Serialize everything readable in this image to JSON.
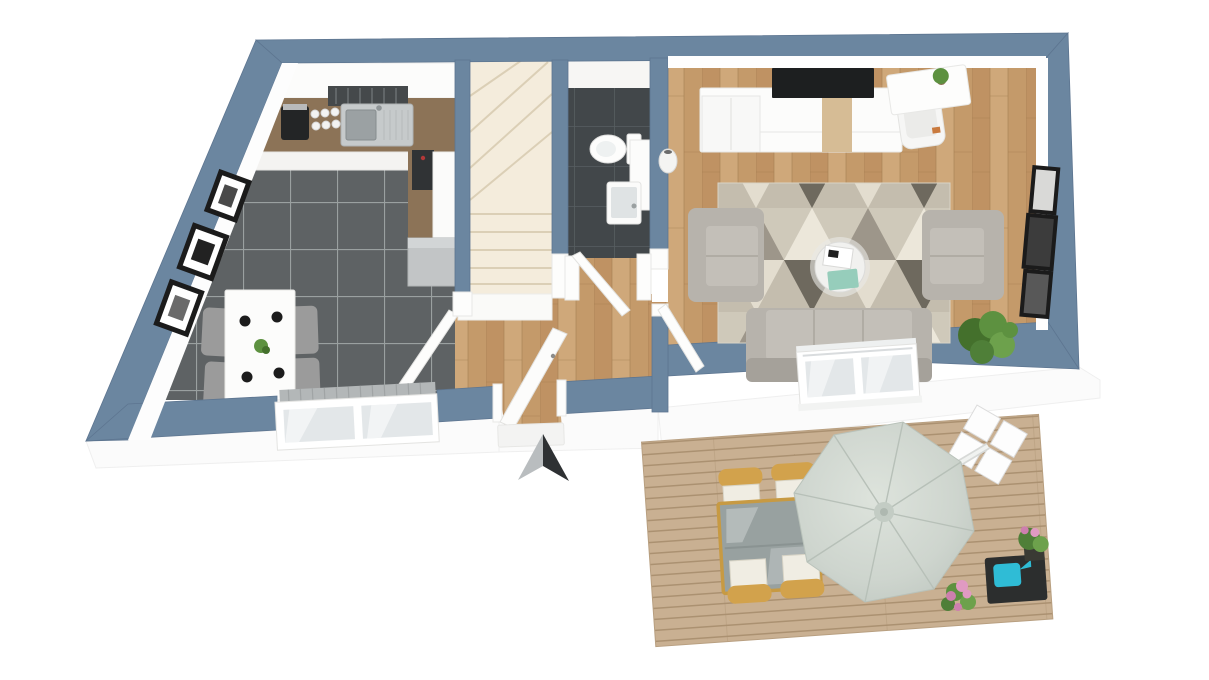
{
  "scene": {
    "type": "3d-floor-plan-render",
    "view": "top-down isometric cutaway",
    "description": "First floor apartment: kitchen-diner with dark tile, entrance hall, winder staircase, bathroom, living room with wood floor, and outdoor wooden terrace with parasol"
  },
  "compass": {
    "points": "north",
    "style": "3d arrowhead marker"
  },
  "palette": {
    "wall_top": "#6b86a0",
    "wall_edge": "#5d7590",
    "wall_face": "#ffffff",
    "exterior": "#fbfbfb",
    "exterior_line": "#ececec",
    "kitchen_tile": "#5e6264",
    "kitchen_grout": "#9aa0a0",
    "bath_tile": "#42474a",
    "bath_grout": "#575e61",
    "wood": "#c79e6f",
    "wood_dark": "#a27c50",
    "plank_a": "#bf9263",
    "plank_b": "#cfa87a",
    "plank_c": "#c49a6a",
    "deck": "#c9b092",
    "deck_line": "#a88e6e",
    "stairs": "#f4ecdc",
    "stairs_line": "#dbcfb6",
    "counter": "#8c7357",
    "cabinet": "#fbfbfa",
    "appliance": "#303335",
    "steel": "#c6cacb",
    "hood": "#45494b",
    "table_white": "#fcfcfb",
    "chair_gray": "#9b9b9b",
    "rug_bg": "#cfc9ba",
    "rug_light": "#ece7da",
    "rug_taupe": "#9d968a",
    "rug_dark": "#6e695e",
    "rug_cream": "#e3ddcf",
    "rug_row2": "#c4bdae",
    "sofa": "#b7b3ac",
    "sofa_seat": "#c3bfb8",
    "sofa_dark": "#a5a19a",
    "coffee_table": "#f1f1ef",
    "tray_mint": "#96cdbb",
    "plant": "#5d9140",
    "plant_dark": "#44702c",
    "frame": "#1b1b1b",
    "umbrella": "#ced5ce",
    "umbrella_rib": "#b7c0b8",
    "wicker": "#d2a24c",
    "cushion": "#f0ede3",
    "glass": "#98a1a0",
    "teal": "#2fbcd6",
    "pink": "#e09ac2",
    "pink_dark": "#cd7fae",
    "stand_dark": "#2c2e2e",
    "radiator": "#b3b7b8",
    "pane": "#e3e7e9",
    "arrow_dark": "#2e3133",
    "arrow_light": "#b9bdbf",
    "tv": "#1d1f20",
    "wood_accent": "#d6bc95"
  },
  "rooms": [
    {
      "id": "kitchen-dining",
      "label": "Kitchen / Dining",
      "floor": "dark gray tile",
      "furniture": [
        "L-shaped counter",
        "cooker hood",
        "stainless sink",
        "coffee machine",
        "cups",
        "built-in oven",
        "fridge column",
        "gray base unit",
        "white dining table",
        "four gray chairs",
        "three wall frames",
        "window with radiator"
      ]
    },
    {
      "id": "hallway",
      "label": "Entrance Hall",
      "floor": "oak wood",
      "furniture": [
        "front door (open)",
        "kitchen door (open)",
        "threshold step"
      ]
    },
    {
      "id": "staircase",
      "label": "Staircase",
      "floor": "cream winder stairs",
      "furniture": [
        "winder staircase",
        "bottom landing"
      ]
    },
    {
      "id": "bathroom",
      "label": "Bathroom",
      "floor": "anthracite tile",
      "furniture": [
        "toilet",
        "washbasin unit",
        "vanity cabinet",
        "door (open)"
      ]
    },
    {
      "id": "living-room",
      "label": "Living Room",
      "floor": "oak wood",
      "furniture": [
        "tv sideboard",
        "wall tv",
        "desk with chair",
        "floor vase",
        "two armchairs",
        "three-seat sofa",
        "round coffee table",
        "books",
        "mint tray",
        "geometric triangle rug",
        "potted plant",
        "three wall frames",
        "french window with railing"
      ]
    },
    {
      "id": "terrace",
      "label": "Terrace",
      "floor": "wood decking",
      "furniture": [
        "cantilever parasol",
        "parasol cross base",
        "glass dining table",
        "four wicker chairs",
        "flower bouquet",
        "dark plant stand",
        "watering can",
        "potted flowers"
      ]
    }
  ]
}
